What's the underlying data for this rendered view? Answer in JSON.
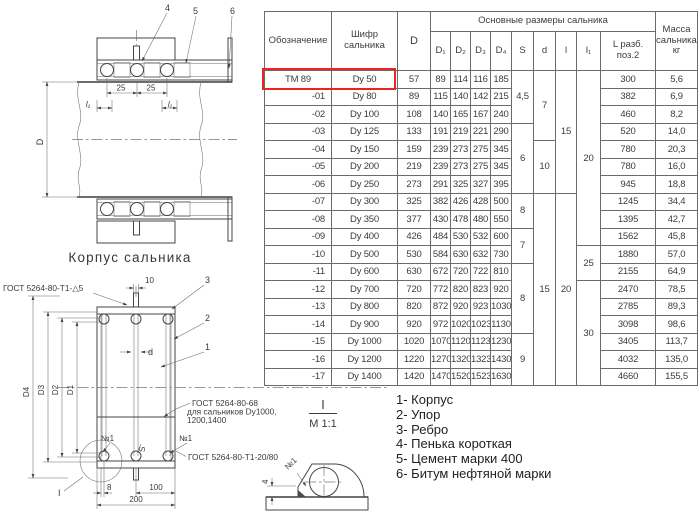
{
  "table": {
    "header": {
      "designation": "Обозначение",
      "code": "Шифр сальника",
      "d_col": "D",
      "group": "Основные размеры сальника",
      "sub": [
        "D₁",
        "D₂",
        "D₃",
        "D₄",
        "S",
        "d",
        "l",
        "l₁",
        "L разб. поз.2"
      ],
      "mass": "Масса сальника, кг"
    },
    "highlight_color": "#e8251f",
    "rows": [
      [
        "ТМ 89",
        "Dy 50",
        "57",
        "89",
        "114",
        "116",
        "185",
        "300",
        "5,6"
      ],
      [
        "-01",
        "Dy 80",
        "89",
        "115",
        "140",
        "142",
        "215",
        "382",
        "6,9"
      ],
      [
        "-02",
        "Dy 100",
        "108",
        "140",
        "165",
        "167",
        "240",
        "460",
        "8,2"
      ],
      [
        "-03",
        "Dy 125",
        "133",
        "191",
        "219",
        "221",
        "290",
        "520",
        "14,0"
      ],
      [
        "-04",
        "Dy 150",
        "159",
        "239",
        "273",
        "275",
        "345",
        "780",
        "20,3"
      ],
      [
        "-05",
        "Dy 200",
        "219",
        "239",
        "273",
        "275",
        "345",
        "780",
        "16,0"
      ],
      [
        "-06",
        "Dy 250",
        "273",
        "291",
        "325",
        "327",
        "395",
        "945",
        "18,8"
      ],
      [
        "-07",
        "Dy 300",
        "325",
        "382",
        "426",
        "428",
        "500",
        "1245",
        "34,4"
      ],
      [
        "-08",
        "Dy 350",
        "377",
        "430",
        "478",
        "480",
        "550",
        "1395",
        "42,7"
      ],
      [
        "-09",
        "Dy 400",
        "426",
        "484",
        "530",
        "532",
        "600",
        "1562",
        "45,8"
      ],
      [
        "-10",
        "Dy 500",
        "530",
        "584",
        "630",
        "632",
        "730",
        "1880",
        "57,0"
      ],
      [
        "-11",
        "Dy 600",
        "630",
        "672",
        "720",
        "722",
        "810",
        "2155",
        "64,9"
      ],
      [
        "-12",
        "Dy 700",
        "720",
        "772",
        "820",
        "823",
        "920",
        "2470",
        "78,5"
      ],
      [
        "-13",
        "Dy 800",
        "820",
        "872",
        "920",
        "923",
        "1030",
        "2785",
        "89,3"
      ],
      [
        "-14",
        "Dy 900",
        "920",
        "972",
        "1020",
        "1023",
        "1130",
        "3098",
        "98,6"
      ],
      [
        "-15",
        "Dy 1000",
        "1020",
        "1070",
        "1120",
        "1123",
        "1230",
        "3405",
        "113,7"
      ],
      [
        "-16",
        "Dy 1200",
        "1220",
        "1270",
        "1320",
        "1323",
        "1430",
        "4032",
        "135,0"
      ],
      [
        "-17",
        "Dy 1400",
        "1420",
        "1470",
        "1520",
        "1523",
        "1630",
        "4660",
        "155,5"
      ]
    ],
    "merged": {
      "S": [
        [
          "4,5",
          3
        ],
        [
          "6",
          4
        ],
        [
          "8",
          2
        ],
        [
          "7",
          2
        ],
        [
          "8",
          4
        ],
        [
          "9",
          3
        ]
      ],
      "d": [
        [
          "7",
          4
        ],
        [
          "10",
          3
        ],
        [
          "15",
          11
        ]
      ],
      "l": [
        [
          "15",
          7
        ],
        [
          "20",
          11
        ]
      ],
      "l1": [
        [
          "20",
          10
        ],
        [
          "25",
          2
        ],
        [
          "30",
          6
        ]
      ]
    }
  },
  "legend": {
    "items": [
      "1- Корпус",
      "2- Упор",
      "3- Ребро",
      "4- Пенька короткая",
      "5- Цемент марки 400",
      "6- Битум нефтяной марки"
    ]
  },
  "drawings": {
    "caption": "Корпус сальника",
    "section": {
      "callout4": "4",
      "callout5": "5",
      "callout6": "6",
      "dim25a": "25",
      "dim25b": "25",
      "dimL1a": "l₁",
      "dimL1b": "l₁",
      "dimD": "D"
    },
    "front": {
      "callout1": "1",
      "callout2": "2",
      "callout3": "3",
      "dimD4": "D4",
      "dimD3": "D3",
      "dimD2": "D2",
      "dimD1": "D1",
      "dim_d": "d",
      "dim_S": "S",
      "dim8": "8",
      "dim100": "100",
      "dim200": "200",
      "dim10": "10",
      "weld_top": "ГОСТ 5264-80-Т1-△5",
      "note1": "ГОСТ 5264-80-68",
      "note2": "для сальников Dy1000,",
      "note3": "1200,1400",
      "weld_bottom": "ГОСТ 5264-80-Т1-20/80",
      "no1_left": "№1",
      "no1_right": "№1"
    },
    "detail": {
      "title": "І",
      "scale": "М 1:1",
      "no1": "№1",
      "dim4": "4"
    }
  }
}
